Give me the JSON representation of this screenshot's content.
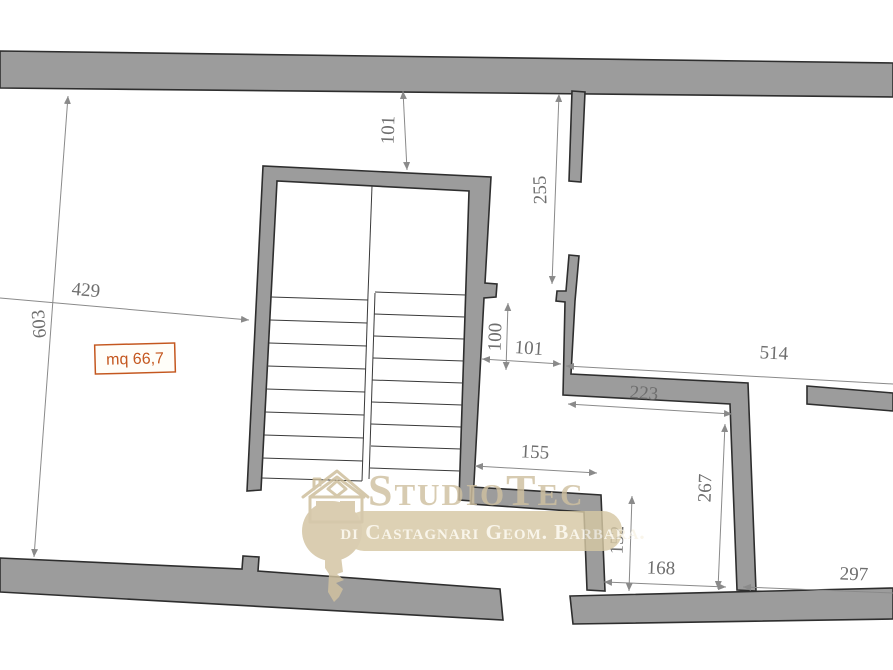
{
  "plan": {
    "area_label": "mq 66,7",
    "watermark": {
      "brand": "StudioTec",
      "subtitle": "di Castagnari  Geom. Barbara."
    },
    "dimensions": {
      "stair_top_offset": "101",
      "upper_right_wall": "255",
      "room_left_width": "429",
      "room_left_height": "603",
      "mid_opening_height": "100",
      "mid_opening_width": "101",
      "right_room_width": "514",
      "center_room_width": "223",
      "corridor_width": "155",
      "lower_right_room_height": "267",
      "lower_center_height": "152",
      "lower_center_width": "168",
      "lower_right_width": "297"
    },
    "colors": {
      "wall_fill": "#9c9c9c",
      "wall_stroke": "#2e2e2e",
      "dimension_gray": "#8a8a8a",
      "area_accent": "#c4571f",
      "watermark_beige": "#d2c3a0"
    }
  }
}
